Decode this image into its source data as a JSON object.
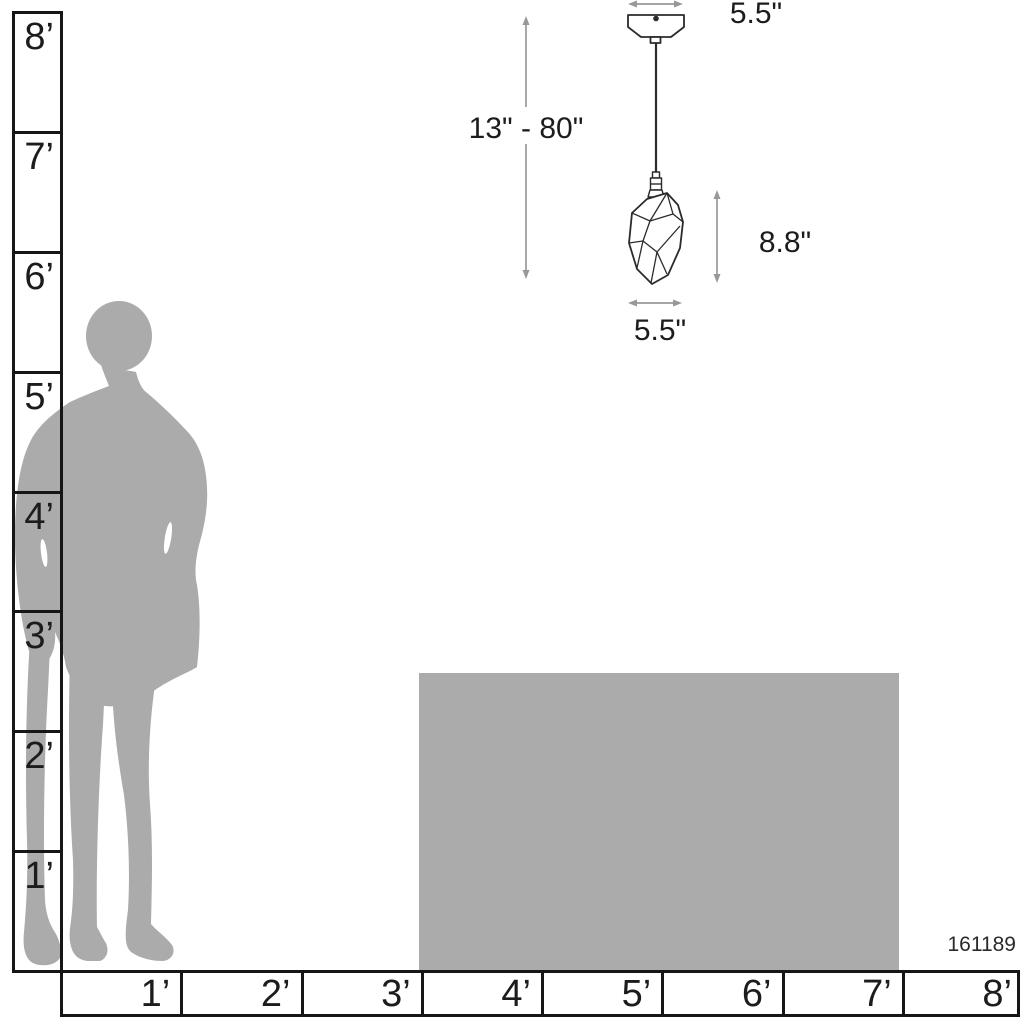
{
  "product_number": "161189",
  "vertical_ruler": {
    "unit": "feet",
    "labels": [
      "8’",
      "7’",
      "6’",
      "5’",
      "4’",
      "3’",
      "2’",
      "1’"
    ]
  },
  "horizontal_ruler": {
    "unit": "feet",
    "labels": [
      "1’",
      "2’",
      "3’",
      "4’",
      "5’",
      "6’",
      "7’",
      "8’"
    ]
  },
  "dimensions": {
    "canopy_width": "5.5\"",
    "hanging_height": "13\" - 80\"",
    "shade_height": "8.8\"",
    "shade_width": "5.5\""
  },
  "colors": {
    "silhouette_gray": "#ababab",
    "arrow_gray": "#989898",
    "line_black": "#161616",
    "fixture_line": "#2b2b2b"
  }
}
